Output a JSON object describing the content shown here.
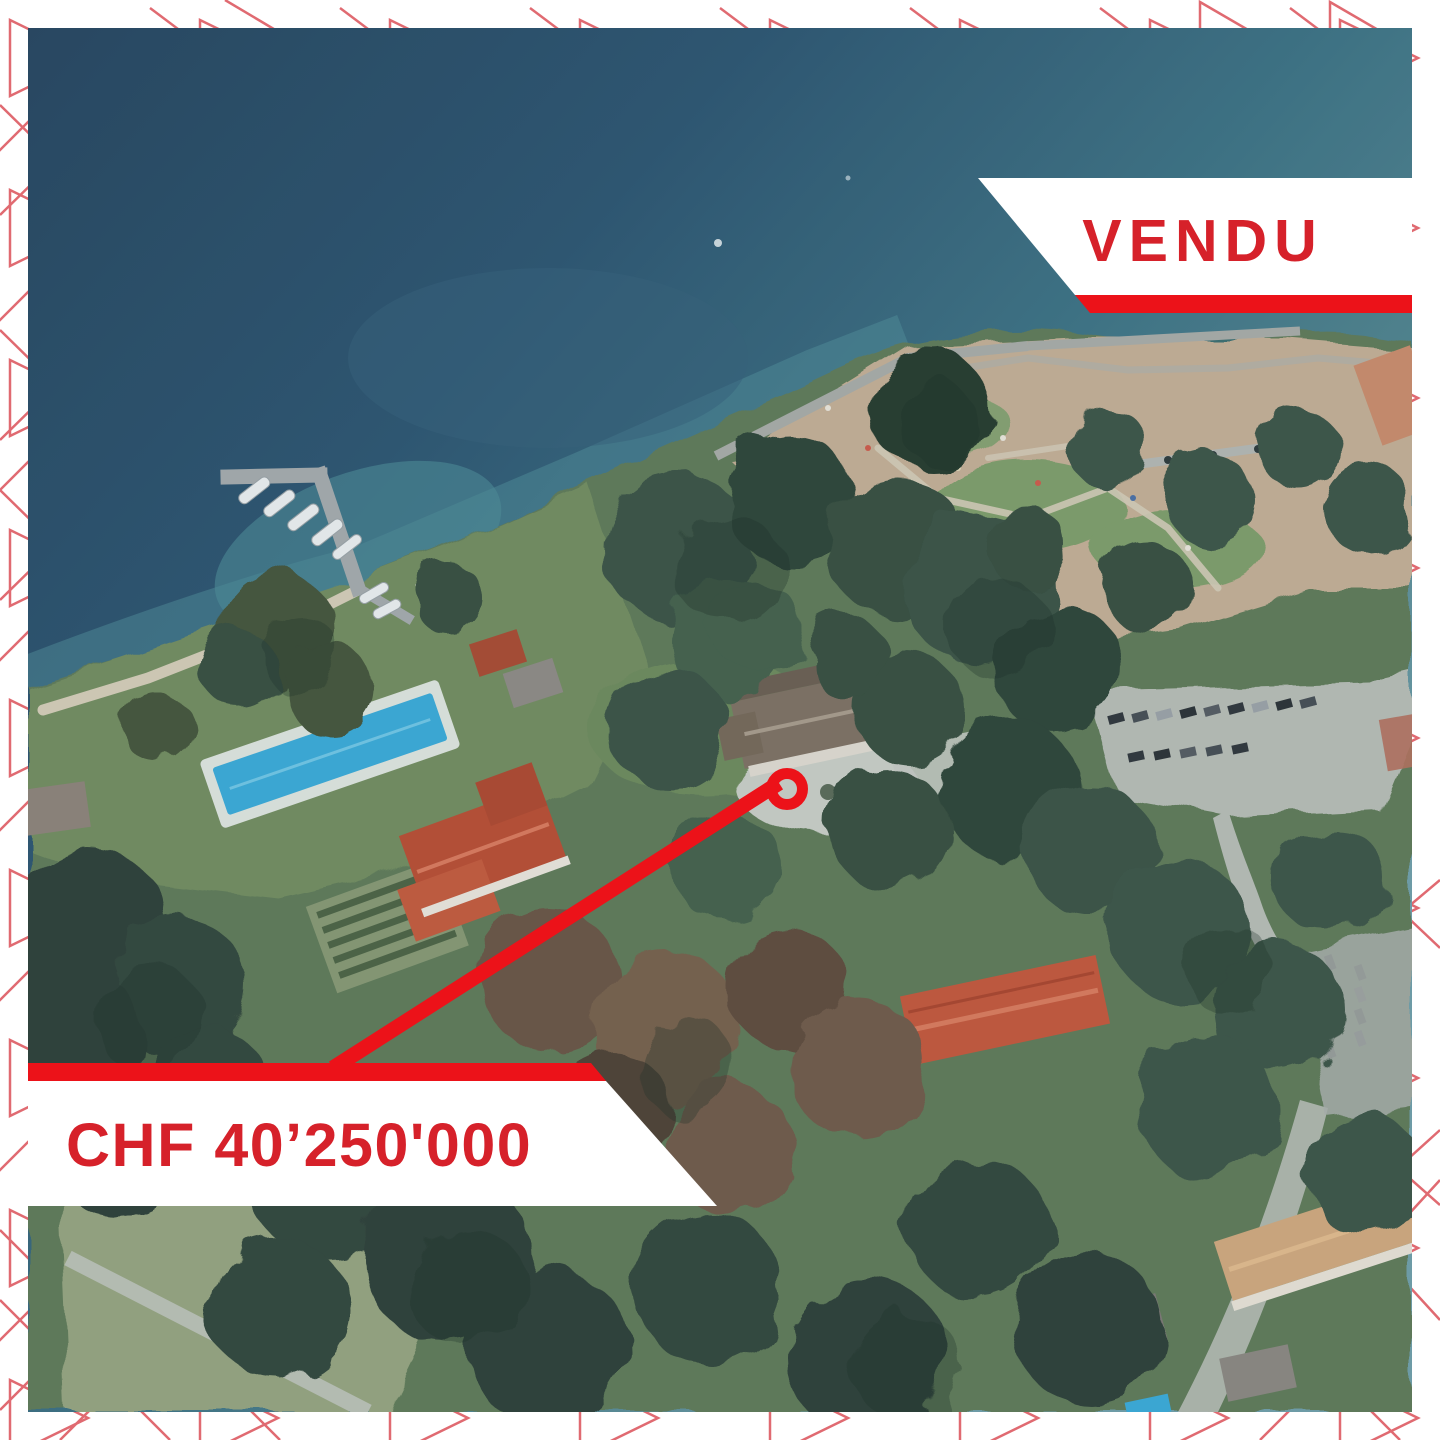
{
  "post": {
    "status_banner": {
      "label": "VENDU"
    },
    "price_banner": {
      "label": "CHF 40’250'000"
    }
  },
  "colors": {
    "accent_red": "#ec1219",
    "text_red": "#d6212a",
    "pattern_red": "#e06a71",
    "banner_white": "#ffffff"
  }
}
